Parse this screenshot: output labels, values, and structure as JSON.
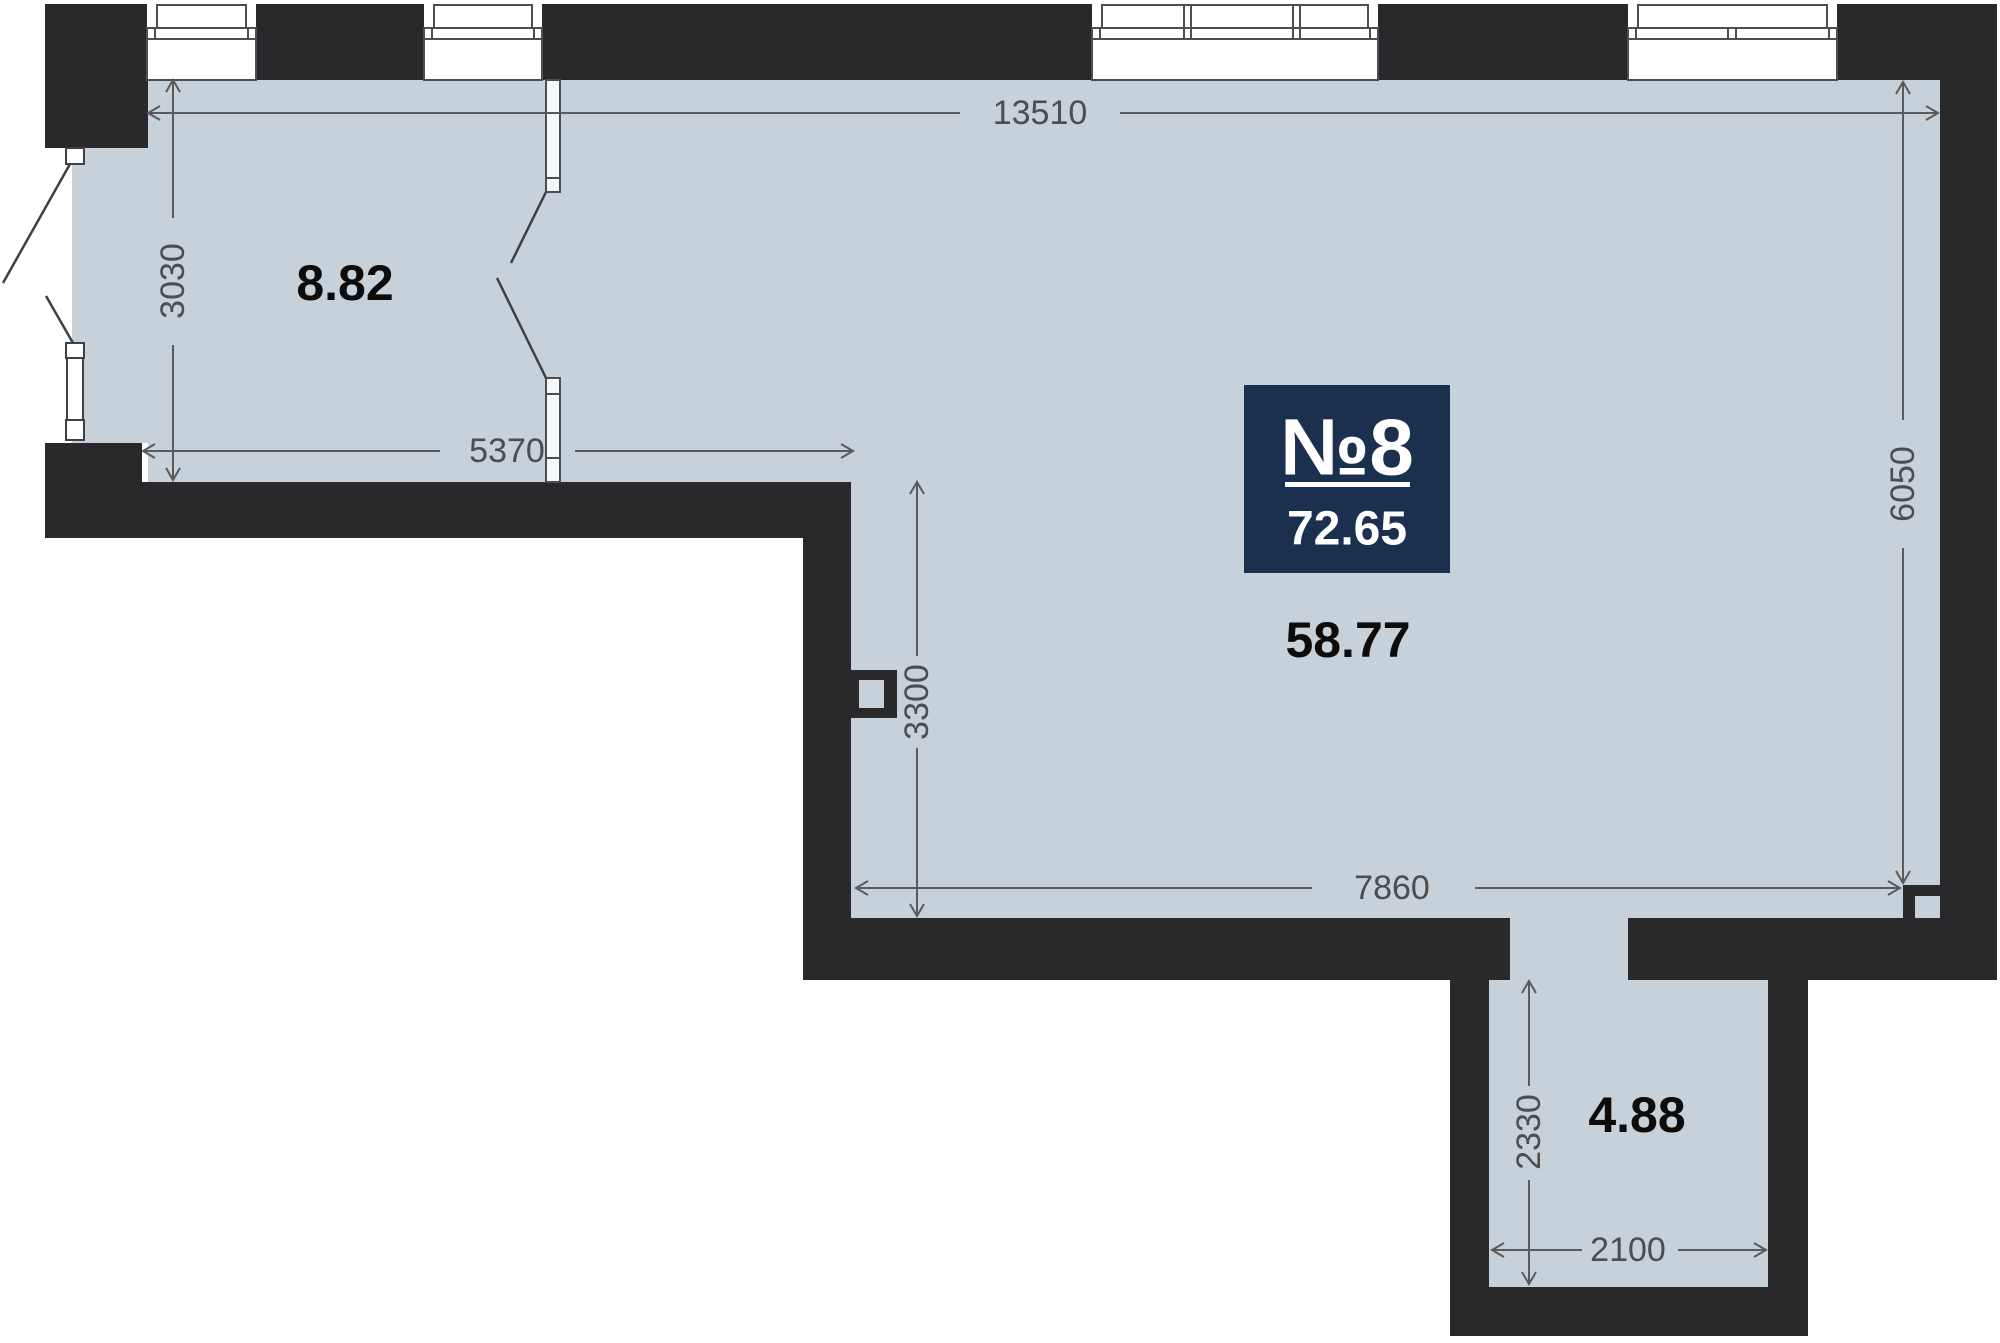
{
  "plan": {
    "badge": {
      "unit_number": "№8",
      "total_area": "72.65"
    },
    "rooms": [
      {
        "id": "room-top-left",
        "area": "8.82"
      },
      {
        "id": "room-main",
        "area": "58.77"
      },
      {
        "id": "room-hall",
        "area": "4.88"
      }
    ],
    "dimensions": {
      "top_width": "13510",
      "room1_height": "3030",
      "room1_width": "5370",
      "main_left_height": "3300",
      "right_height": "6050",
      "main_bottom_width": "7860",
      "hall_height": "2330",
      "hall_width": "2100"
    },
    "colors": {
      "floor": "#c7d1da",
      "wall": "#29292b",
      "badge": "#1b2f4f",
      "dim_line": "#5a5a5a",
      "dim_text": "#4d4d4d",
      "room_label": "#0c0c0c",
      "frame_stroke": "#4b4e53",
      "door_swing": "#3e4144",
      "window_fill": "#ffffff"
    }
  }
}
